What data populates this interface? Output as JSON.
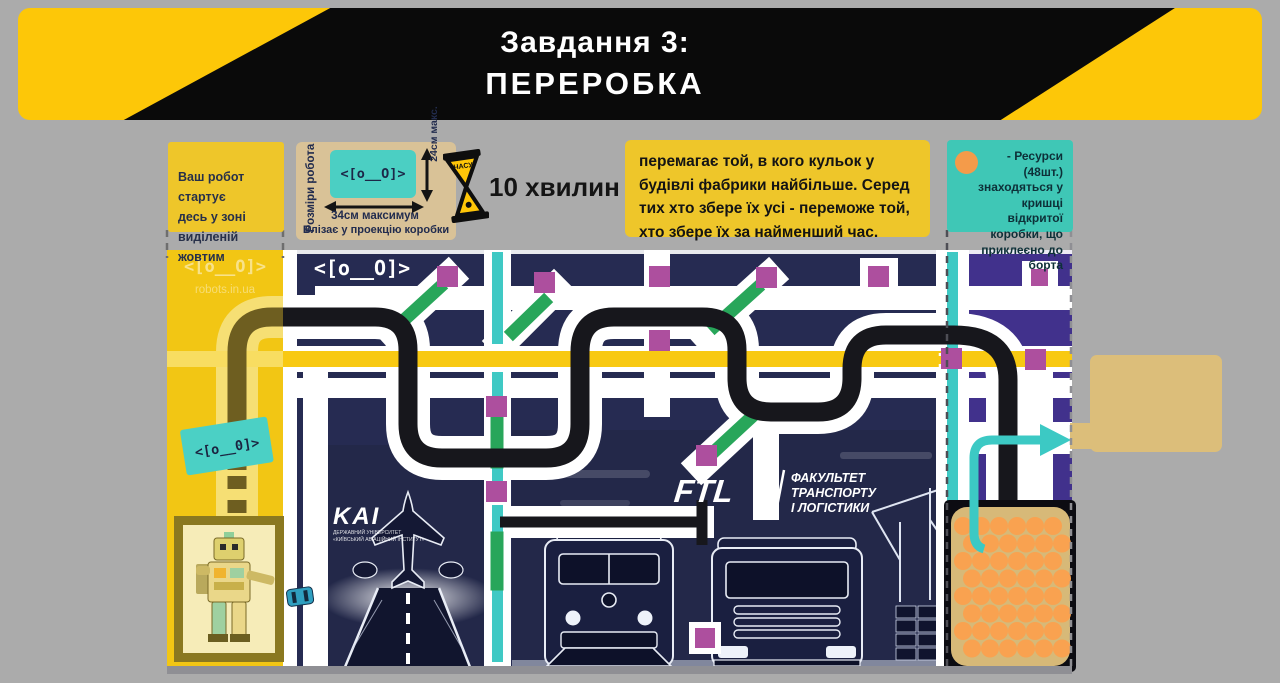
{
  "banner": {
    "line1": "Завдання 3:",
    "line2": "ПЕРЕРОБКА"
  },
  "notes": {
    "start_zone": "Ваш робот стартує\nдесь у зоні\nвиділеній жовтим",
    "robot_size": {
      "side_label": "Розміри робота",
      "face": "<[o__O]>",
      "width_label": "34см максимум",
      "height_label": "24см макс.",
      "fit_label": "Влізає у проекцію коробки"
    },
    "timer": {
      "hourglass_label": "ЧАСУ",
      "duration": "10 хвилин"
    },
    "win_rule": "перемагає той, в кого кульок у\nбудівлі фабрики найбільше. Серед\nтих хто збере їх усі - переможе той,\nхто збере їх за найменший час.",
    "resources": "- Ресурси (48шт.)\nзнаходяться у\nкришці відкритої\nкоробки, що\nприклеєно до борта"
  },
  "field": {
    "watermark_line1": "<[o__O]>",
    "watermark_line2": "robots.in.ua",
    "logo_line1": "<[o__O]>",
    "logo_line2": "REAL GAME",
    "start_sticker": "<[o__0]>",
    "kai": {
      "title": "KAI",
      "sub1": "ДЕРЖАВНИЙ УНІВЕРСИТЕТ",
      "sub2": "«КИЇВСЬКИЙ АВІАЦІЙНИЙ ІНСТИТУТ»"
    },
    "ftl": {
      "logo": "FTL",
      "line1": "ФАКУЛЬТЕТ",
      "line2": "ТРАНСПОРТУ",
      "line3": "І ЛОГІСТИКИ"
    },
    "resource_count": 48
  },
  "colors": {
    "bg_gray": "#ababab",
    "banner_yellow": "#fdc708",
    "note_yellow": "#eec62a",
    "note_cyan": "#3fc7b6",
    "note_beige": "#d9c297",
    "zone_yellow": "#f2c614",
    "field_navy": "#262b52",
    "zone_purple": "#41318c",
    "road_yellow": "#f8c912",
    "path_black": "#17171c",
    "stripe_cyan": "#3fc9c4",
    "seg_green": "#28a65a",
    "square_purple": "#ad4f9e",
    "ball_orange": "#f9a250",
    "lid_tan": "#d7b978",
    "outer_box_beige": "#dcbe7a"
  }
}
